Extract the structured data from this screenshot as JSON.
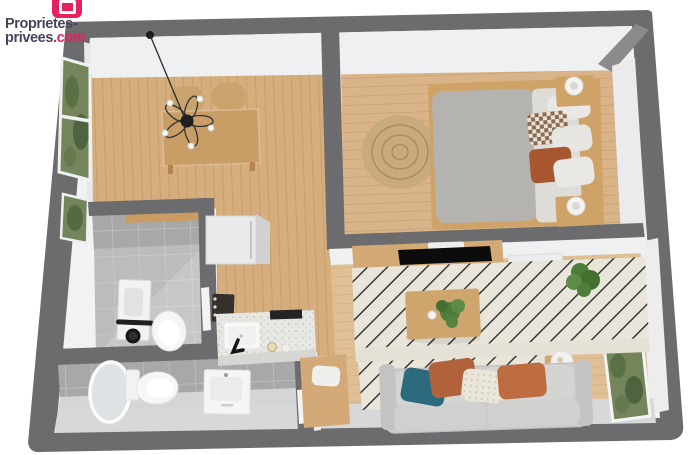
{
  "brand": {
    "icon": "proprietes-privees-logo-icon",
    "line1": "Proprietes-",
    "line2_name": "privees",
    "line2_tld": ".com"
  },
  "colors": {
    "background": "#ffffff",
    "wall": "#6c6c6e",
    "wall_face_light": "#eef0f1",
    "wall_face_bottom": "#d8d8da",
    "wood_floor": "#d6ae7e",
    "tile_wall": "#a6a8aa",
    "tile_floor": "#c5c7c9",
    "wc_floor": "#d3d5d7",
    "rug_base": "#e9e5da",
    "rug_stripe": "#2d2d2d",
    "round_rug": "#c9aa7c",
    "sofa": "#cccccb",
    "cushion_teal": "#2c6b7e",
    "cushion_rust": "#b2623a",
    "cushion_knit": "#eae6da",
    "bed_duvet": "#b5b3af",
    "bed_sheet": "#dddcd7",
    "wood_furniture": "#cfa267",
    "plant_green": "#4e7c3a",
    "window_green": "#74855c",
    "appliance_white": "#f2f2f1",
    "brand_pink": "#e6215f",
    "brand_text": "#45445a"
  },
  "scene": {
    "view": "3d-floor-plan-top-down",
    "rooms": [
      {
        "name": "dining-room",
        "furniture": [
          "dining-table",
          "rattan-chairs",
          "pendant-chandelier",
          "window"
        ]
      },
      {
        "name": "bedroom",
        "furniture": [
          "double-bed",
          "pillows",
          "nightstands",
          "lamps",
          "round-jute-rug"
        ]
      },
      {
        "name": "bathroom",
        "furniture": [
          "washing-machine",
          "toilet",
          "wood-shelf"
        ]
      },
      {
        "name": "wc",
        "furniture": [
          "round-mirror",
          "toilet",
          "vanity-sink"
        ]
      },
      {
        "name": "kitchen",
        "furniture": [
          "fridge",
          "stove",
          "counter",
          "sink",
          "faucet",
          "hob"
        ]
      },
      {
        "name": "living-room",
        "furniture": [
          "tv-console",
          "tv",
          "striped-rug",
          "coffee-table",
          "potted-plants",
          "sofa",
          "cushions",
          "desk",
          "side-table",
          "window"
        ]
      }
    ]
  }
}
